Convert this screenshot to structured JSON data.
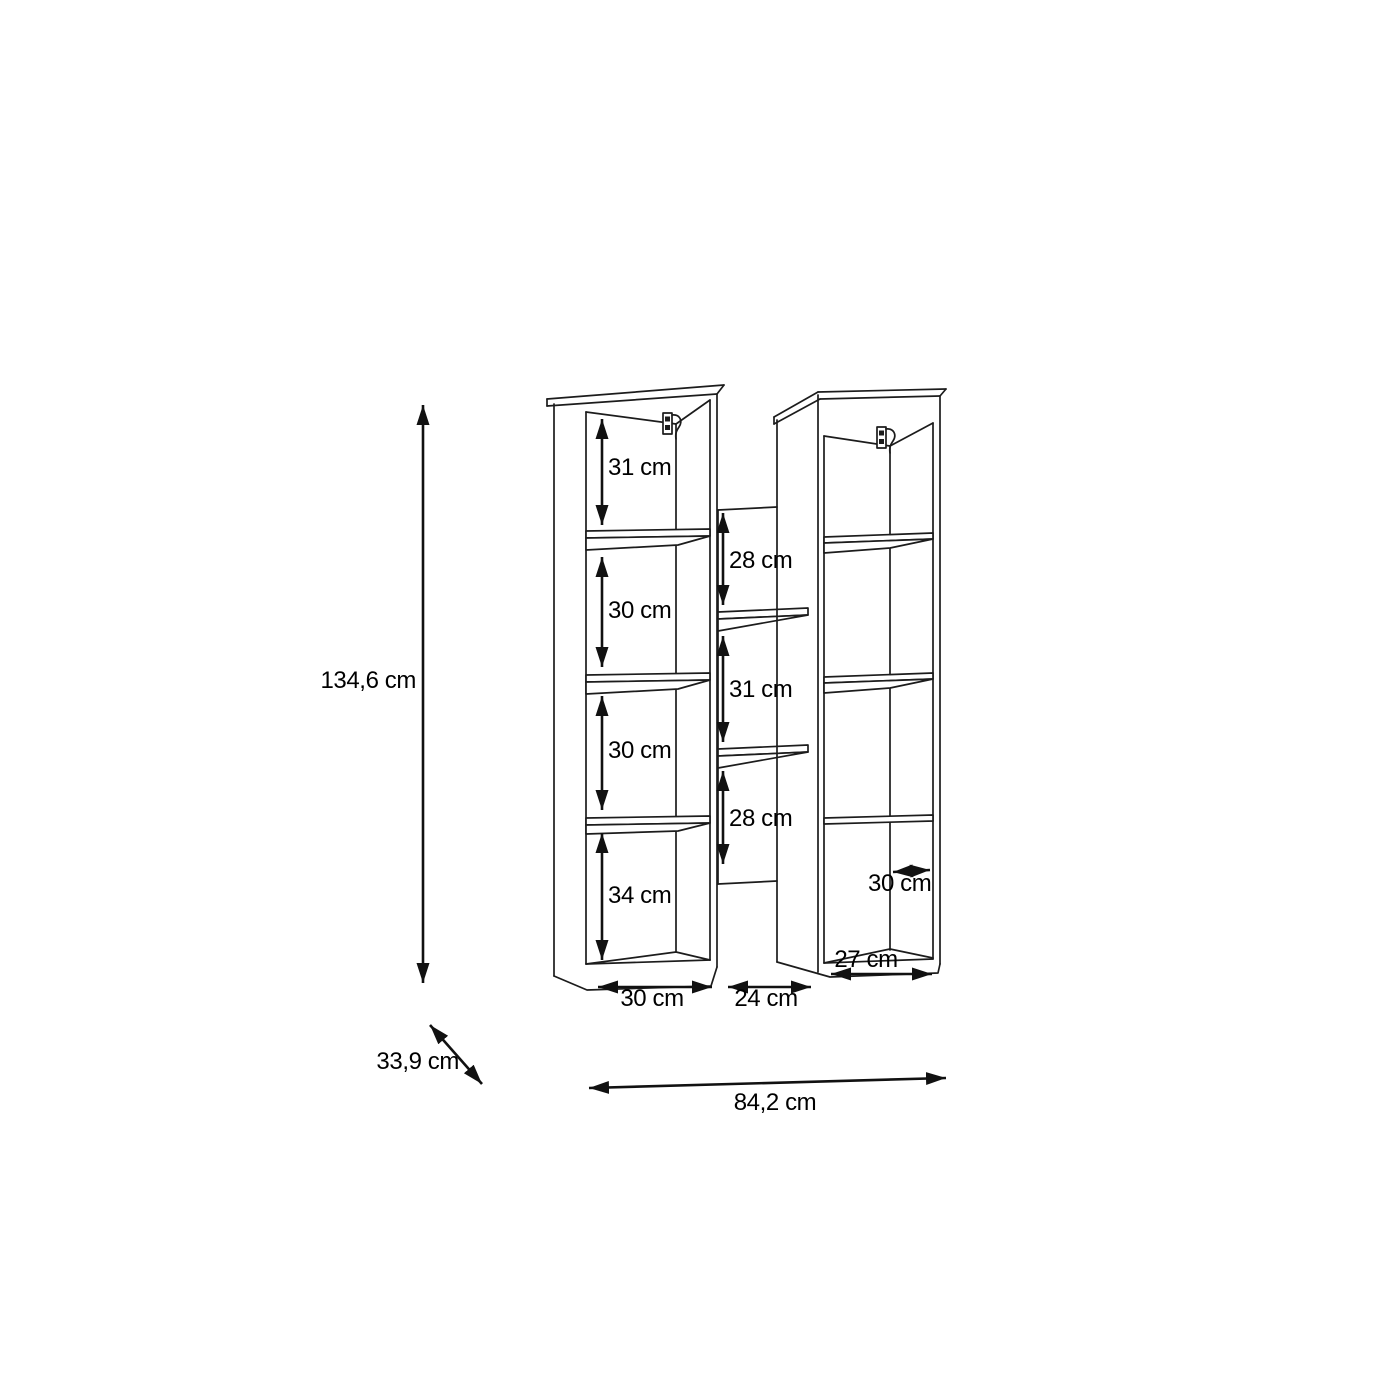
{
  "diagram": {
    "unit": "cm",
    "overall": {
      "height_label": "134,6 cm",
      "depth_label": "33,9 cm",
      "width_label": "84,2 cm"
    },
    "left_column": {
      "cell_labels": [
        "31 cm",
        "30 cm",
        "30 cm",
        "34 cm"
      ],
      "width_label": "30 cm"
    },
    "middle_section": {
      "cell_labels": [
        "28 cm",
        "31 cm",
        "28 cm"
      ],
      "width_label": "24 cm"
    },
    "right_column": {
      "depth_label": "30 cm",
      "width_label": "27 cm"
    },
    "colors": {
      "line": "#1c1c1c",
      "dimension": "#111111",
      "text": "#000000",
      "background": "#ffffff"
    }
  }
}
